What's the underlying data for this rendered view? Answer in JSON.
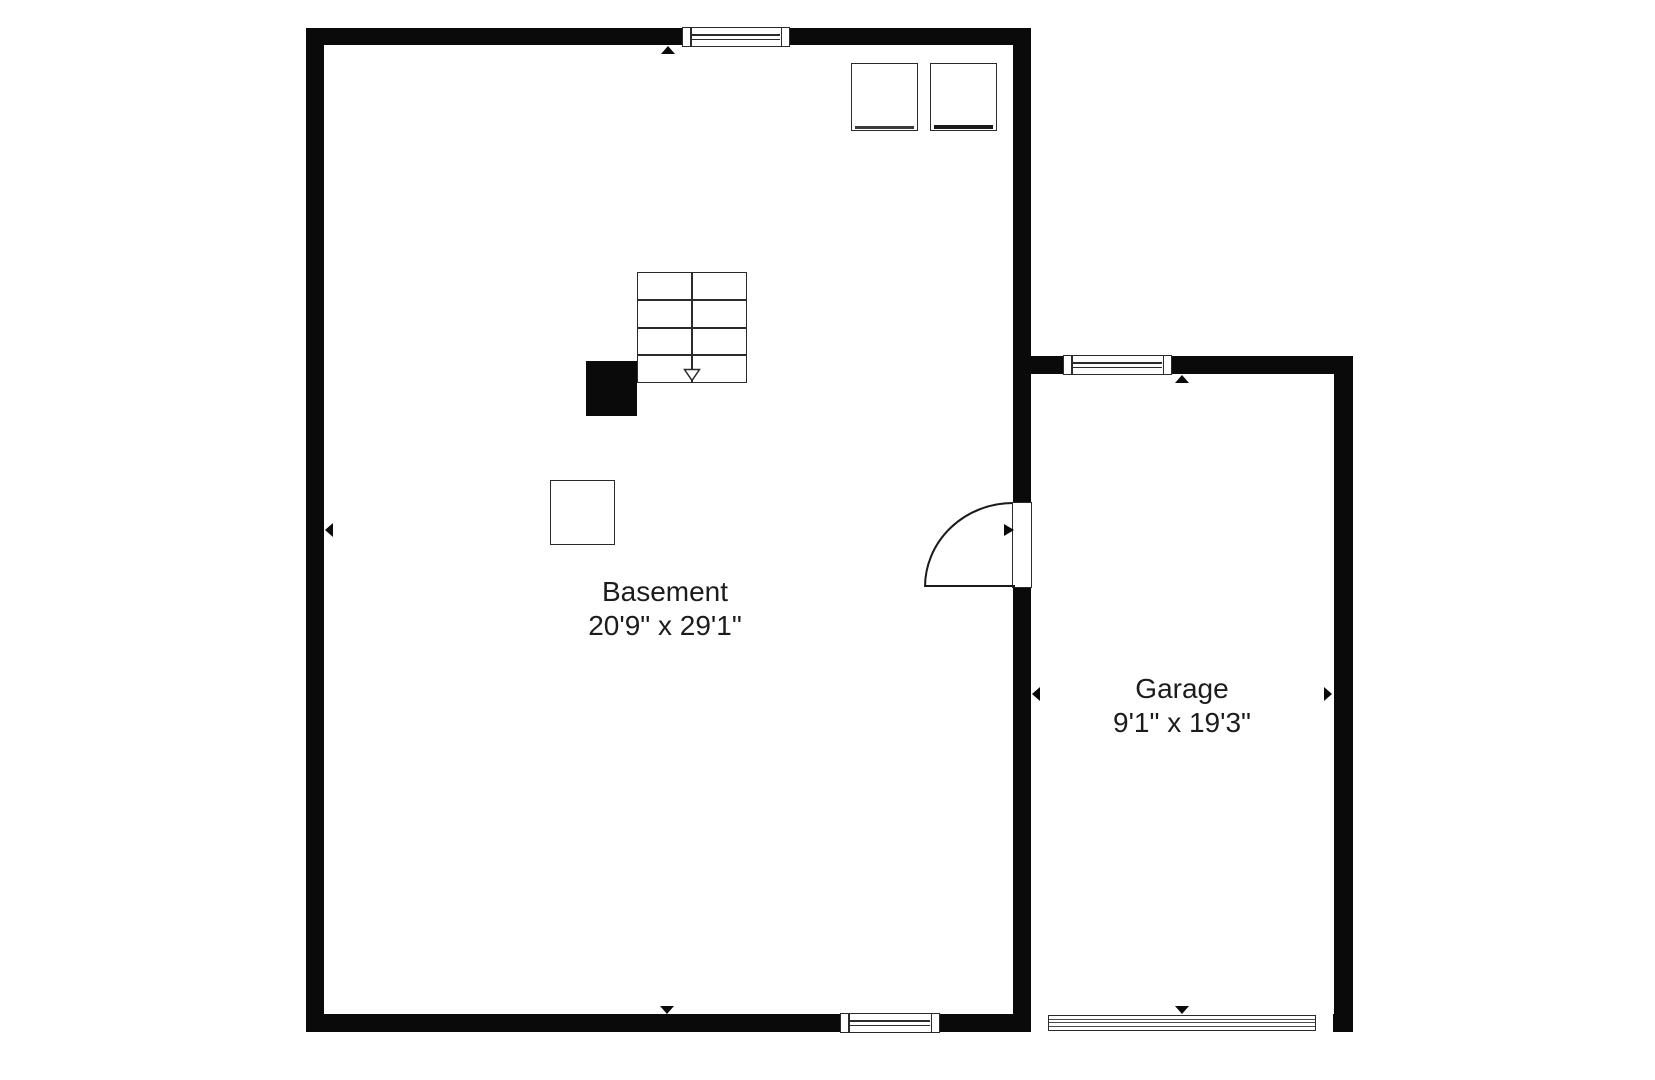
{
  "floor_plan": {
    "title": "Basement floor plan",
    "rooms": [
      {
        "name": "Basement",
        "dimensions": "20'9\" x 29'1\""
      },
      {
        "name": "Garage",
        "dimensions": "9'1\" x 19'3\""
      }
    ],
    "colors": {
      "background": "#ffffff",
      "wall": "#0a0a0a",
      "line": "#2b2b2b",
      "text": "#1c1c1c"
    },
    "icons": {
      "dimension_arrow": "filled-triangle",
      "stairs_direction": "open-triangle-down",
      "door_swing": "quarter-arc",
      "window": "double-pane-rect",
      "garage_door": "striped-band"
    }
  }
}
